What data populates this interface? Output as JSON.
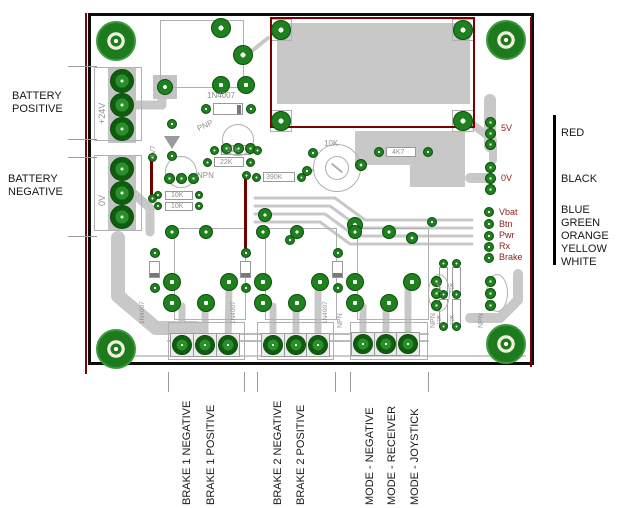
{
  "annotations": {
    "battery_positive": {
      "line1": "BATTERY",
      "line2": "POSITIVE"
    },
    "battery_negative": {
      "line1": "BATTERY",
      "line2": "NEGATIVE"
    },
    "bottom_labels": [
      "BRAKE 1 NEGATIVE",
      "BRAKE 1 POSITIVE",
      "BRAKE 2 NEGATIVE",
      "BRAKE 2 POSITIVE",
      "MODE - NEGATIVE",
      "MODE - RECEIVER",
      "MODE - JOYSTICK"
    ],
    "wire_colors": {
      "v5": "RED",
      "v0": "BLACK",
      "pins": [
        "BLUE",
        "GREEN",
        "ORANGE",
        "YELLOW",
        "WHITE"
      ]
    }
  },
  "board": {
    "terminals": {
      "positive": "+24V",
      "negative": "0V"
    },
    "headers": {
      "v5": "5V",
      "v0": "0V",
      "pins": [
        "Vbat",
        "Btn",
        "Pwr",
        "Rx",
        "Brake"
      ]
    },
    "silkscreen": {
      "diode_top": "1N4007",
      "pnp": "PNP",
      "r22k_a": "22K",
      "r22k_b": "22K",
      "r4k7": "4K7",
      "r390k": "390K",
      "pot": "10K",
      "npn_left": "NPN",
      "r10k_a": "10K",
      "r10k_b": "10K",
      "zener": "4V7",
      "channel_diodes": [
        "1N4007",
        "1N4007",
        "1N4007"
      ],
      "npn_bottom": [
        "NPN",
        "NPN",
        "NPN"
      ],
      "r10k_right": [
        "10K",
        "10K",
        "10K",
        "10K"
      ]
    }
  },
  "colors": {
    "pad_green": "#1e811e",
    "trace_gray": "#c8c8c8",
    "silk_gray": "#8f8f8f",
    "board_outline_red": "#7a0505",
    "pin_label_red": "#8b1e1e"
  }
}
